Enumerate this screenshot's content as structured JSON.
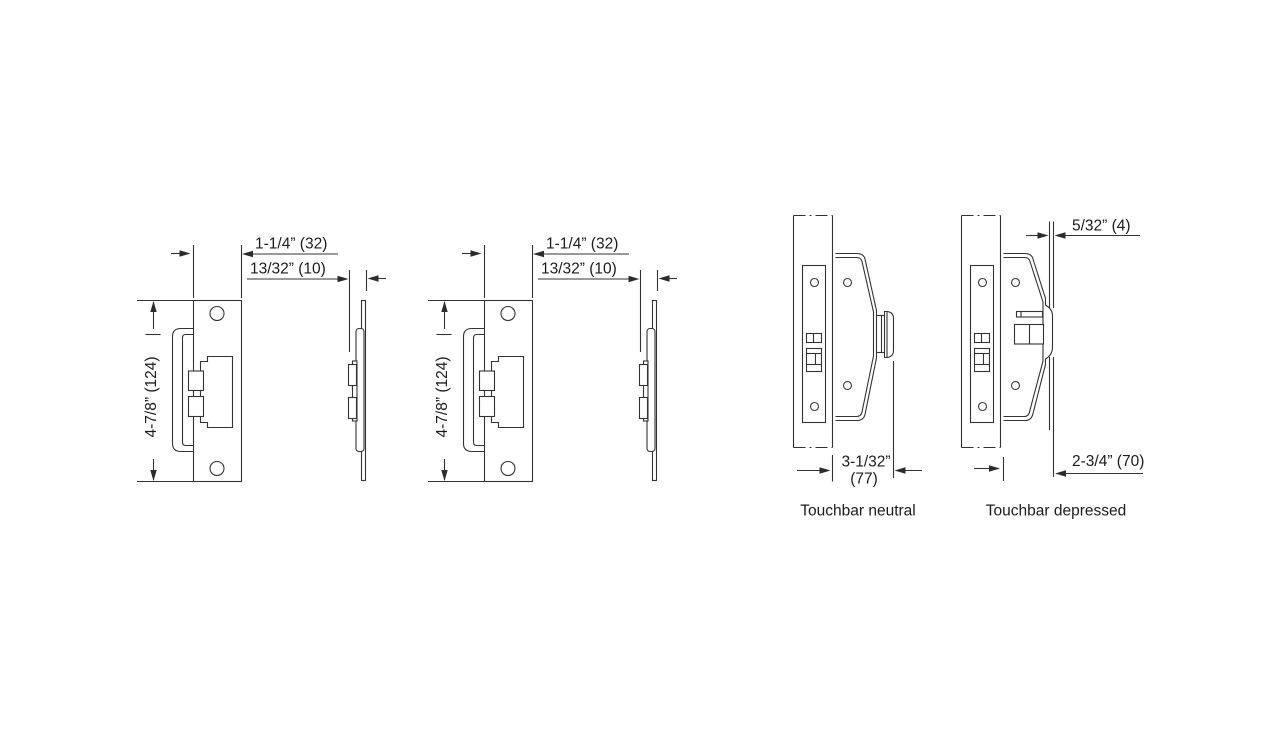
{
  "drawing": {
    "strike_plate": {
      "dim_width": "1-1/4” (32)",
      "dim_offset": "13/32” (10)",
      "dim_height": "4-7/8” (124)"
    },
    "touchbar_neutral": {
      "dim_projection_in": "3-1/32”",
      "dim_projection_mm": "(77)",
      "caption": "Touchbar neutral"
    },
    "touchbar_depressed": {
      "dim_travel": "5/32” (4)",
      "dim_projection": "2-3/4” (70)",
      "caption": "Touchbar depressed"
    }
  }
}
